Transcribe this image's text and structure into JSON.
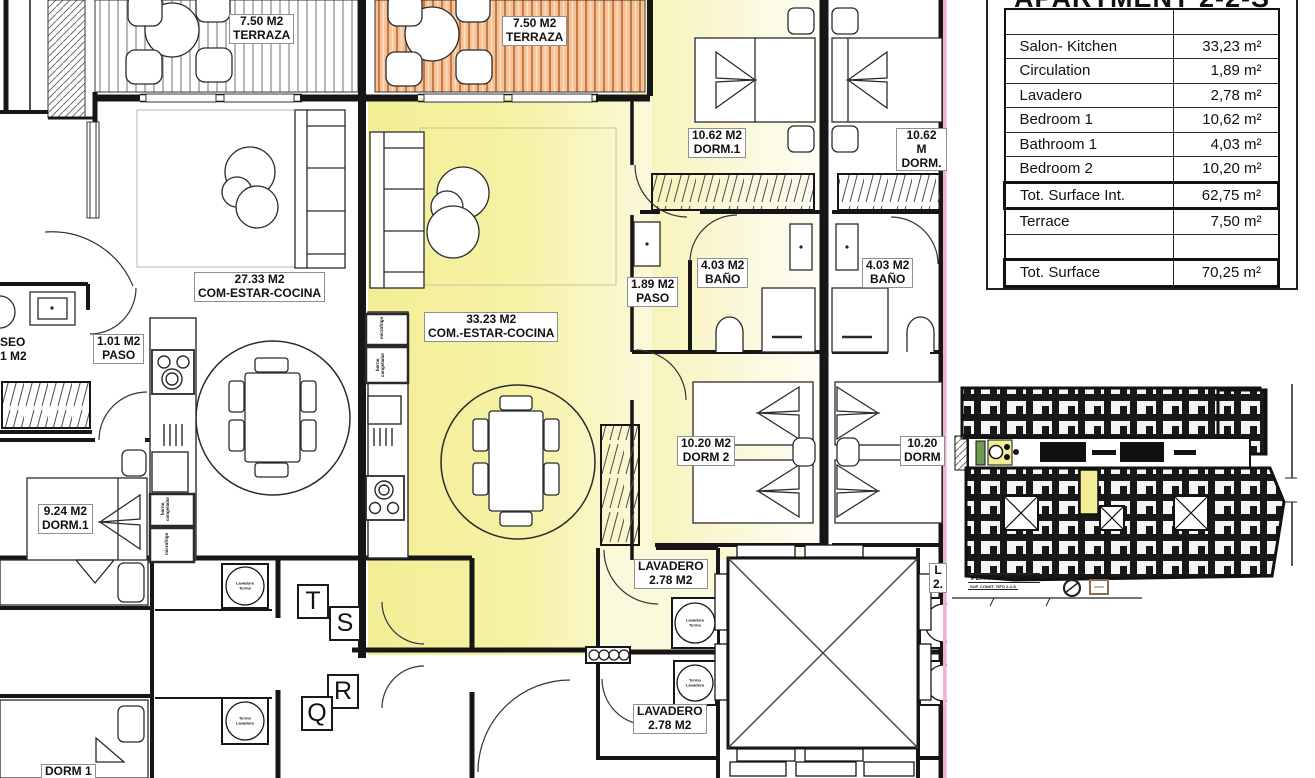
{
  "surface_table": {
    "title": "APARTMENT 2-2-S",
    "rows": [
      {
        "label": "",
        "value": ""
      },
      {
        "label": "Salon- Kitchen",
        "value": "33,23 m²"
      },
      {
        "label": "Circulation",
        "value": "1,89 m²"
      },
      {
        "label": "Lavadero",
        "value": "2,78 m²"
      },
      {
        "label": "Bedroom 1",
        "value": "10,62 m²"
      },
      {
        "label": "Bathroom 1",
        "value": "4,03 m²"
      },
      {
        "label": "Bedroom 2",
        "value": "10,20 m²"
      },
      {
        "label": "Tot. Surface Int.",
        "value": "62,75 m²",
        "cls": "total"
      },
      {
        "label": "Terrace",
        "value": "7,50 m²"
      },
      {
        "label": "",
        "value": ""
      },
      {
        "label": "Tot. Surface",
        "value": "70,25 m²",
        "cls": "total"
      }
    ]
  },
  "plan": {
    "colors": {
      "c_yellow": "#f2ee96",
      "c_yellow_pale": "#fbf9dc",
      "c_orange": "#f6c096",
      "c_pink": "#edb3d9"
    },
    "labels": [
      {
        "id": "terrace-left-label",
        "x": 229,
        "y": 14,
        "text": "7.50 M2\nTERRAZA"
      },
      {
        "id": "terrace-mid-label",
        "x": 502,
        "y": 16,
        "text": "7.50 M2\nTERRAZA"
      },
      {
        "id": "living-left-label",
        "x": 194,
        "y": 272,
        "text": "27.33 M2\nCOM-ESTAR-COCINA"
      },
      {
        "id": "living-mid-label",
        "x": 424,
        "y": 312,
        "text": "33.23 M2\nCOM.-ESTAR-COCINA"
      },
      {
        "id": "paso-mid-label",
        "x": 627,
        "y": 277,
        "text": "1.89 M2\nPASO"
      },
      {
        "id": "paso-left-label",
        "x": 93,
        "y": 334,
        "text": "1.01 M2\nPASO"
      },
      {
        "id": "aseo-label",
        "x": 0,
        "y": 336,
        "text": "SEO\n1 M2",
        "cls": "nobox"
      },
      {
        "id": "dorm1-small-label",
        "x": 38,
        "y": 504,
        "text": "9.24 M2\nDORM.1"
      },
      {
        "id": "dorm1-mid-label",
        "x": 688,
        "y": 128,
        "text": "10.62 M2\nDORM.1"
      },
      {
        "id": "dorm1-right-label",
        "x": 896,
        "y": 128,
        "text": "10.62 M\nDORM."
      },
      {
        "id": "bath-mid-label",
        "x": 697,
        "y": 258,
        "text": "4.03 M2\nBAÑO"
      },
      {
        "id": "bath-right-label",
        "x": 862,
        "y": 258,
        "text": "4.03 M2\nBAÑO"
      },
      {
        "id": "dorm2-mid-label",
        "x": 677,
        "y": 436,
        "text": "10.20 M2\nDORM 2"
      },
      {
        "id": "dorm2-right-label",
        "x": 900,
        "y": 436,
        "text": "10.20\nDORM"
      },
      {
        "id": "lavadero1-label",
        "x": 634,
        "y": 559,
        "text": "LAVADERO\n2.78 M2"
      },
      {
        "id": "lavadero2-label",
        "x": 633,
        "y": 704,
        "text": "LAVADERO\n2.78 M2"
      },
      {
        "id": "lavadero-right-label",
        "x": 929,
        "y": 563,
        "text": "L\n2."
      },
      {
        "id": "dorm1-bottom-label",
        "x": 41,
        "y": 764,
        "text": "DORM 1"
      },
      {
        "id": "grid-letter-t",
        "x": 297,
        "y": 584,
        "text": "T",
        "cls": "grid"
      },
      {
        "id": "grid-letter-s",
        "x": 329,
        "y": 606,
        "text": "S",
        "cls": "grid"
      },
      {
        "id": "grid-letter-r",
        "x": 327,
        "y": 674,
        "text": "R",
        "cls": "grid"
      },
      {
        "id": "grid-letter-q",
        "x": 301,
        "y": 696,
        "text": "Q",
        "cls": "grid"
      },
      {
        "id": "washer1-label",
        "x": 245,
        "y": 586,
        "text": "Lavadora\nTermo",
        "cls": "tiny"
      },
      {
        "id": "washer2-label",
        "x": 245,
        "y": 721,
        "text": "Termo\nLavadora",
        "cls": "tiny"
      },
      {
        "id": "washer3-label",
        "x": 695,
        "y": 623,
        "text": "Lavadora\nTermo",
        "cls": "tiny"
      },
      {
        "id": "washer4-label",
        "x": 695,
        "y": 683,
        "text": "Termo\nLavadora",
        "cls": "tiny"
      },
      {
        "id": "appliance-horno-left",
        "x": 161,
        "y": 524,
        "text": "horno\ncongelador",
        "cls": "rot"
      },
      {
        "id": "appliance-micro-left",
        "x": 165,
        "y": 558,
        "text": "microfrigo",
        "cls": "rot"
      },
      {
        "id": "appliance-micro-mid",
        "x": 380,
        "y": 342,
        "text": "microfrigo",
        "cls": "rot"
      },
      {
        "id": "appliance-horno-mid",
        "x": 376,
        "y": 380,
        "text": "horno\ncongelador",
        "cls": "rot"
      }
    ]
  },
  "key_plan": {
    "caption": "PLANTA SEGUNDA",
    "caption_sub": "SUP. CONST. TIPO 2-2-S"
  }
}
